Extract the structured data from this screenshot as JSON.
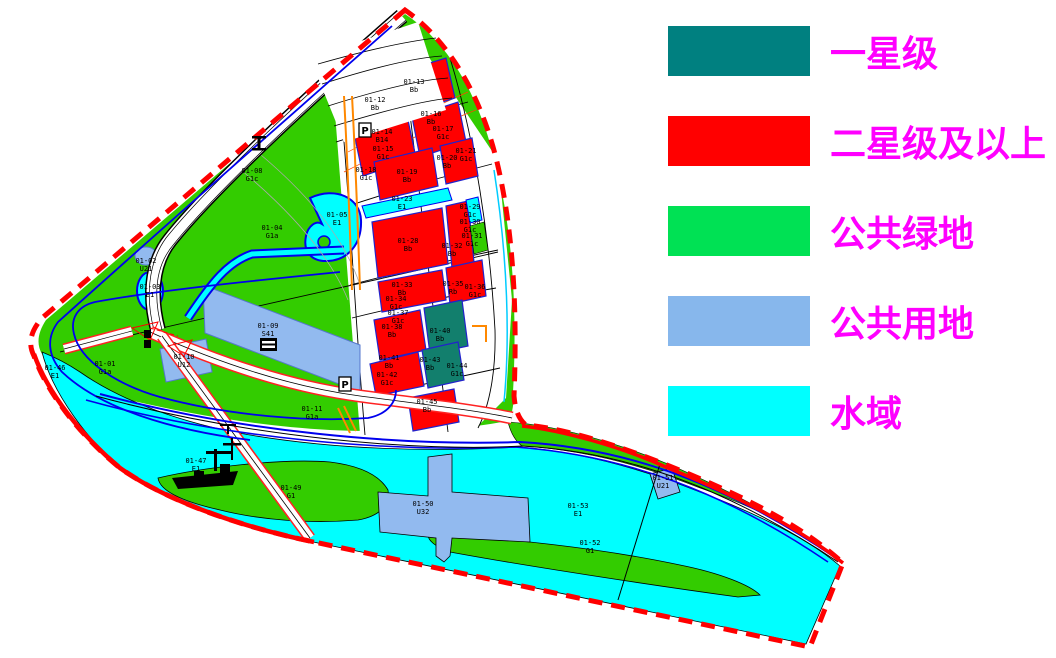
{
  "legend": {
    "text_color": "#FF00FF",
    "items": [
      {
        "label": "一星级",
        "color": "#008080"
      },
      {
        "label": "二星级及以上",
        "color": "#FF0000"
      },
      {
        "label": "公共绿地",
        "color": "#00E154"
      },
      {
        "label": "公共用地",
        "color": "#87B7EC"
      },
      {
        "label": "水域",
        "color": "#00FFFF"
      }
    ]
  },
  "map": {
    "colors": {
      "boundary_red": "#FF0000",
      "green_area": "#33CC00",
      "water_cyan": "#00FFFF",
      "public_blue": "#92BAEF",
      "block_red": "#FF0000",
      "block_teal": "#127F6D",
      "canal_blue": "#0000EE",
      "label_black": "#000000"
    },
    "parking_label": "P",
    "parcels": [
      {
        "c": "01-01",
        "t": "G1a",
        "x": 105,
        "y": 366
      },
      {
        "c": "01-02",
        "t": "U21",
        "x": 146,
        "y": 263
      },
      {
        "c": "01-03",
        "t": "E1",
        "x": 150,
        "y": 289
      },
      {
        "c": "01-04",
        "t": "G1a",
        "x": 272,
        "y": 230
      },
      {
        "c": "01-05",
        "t": "E1",
        "x": 337,
        "y": 217
      },
      {
        "c": "01-08",
        "t": "G1c",
        "x": 252,
        "y": 173
      },
      {
        "c": "01-09",
        "t": "S41",
        "x": 268,
        "y": 328
      },
      {
        "c": "01-10",
        "t": "U12",
        "x": 184,
        "y": 359
      },
      {
        "c": "01-11",
        "t": "G1a",
        "x": 312,
        "y": 411
      },
      {
        "c": "01-12",
        "t": "Bb",
        "x": 375,
        "y": 102
      },
      {
        "c": "01-13",
        "t": "Bb",
        "x": 414,
        "y": 84
      },
      {
        "c": "01-14",
        "t": "B14",
        "x": 382,
        "y": 134
      },
      {
        "c": "01-15",
        "t": "G1c",
        "x": 383,
        "y": 151
      },
      {
        "c": "01-16",
        "t": "Bb",
        "x": 431,
        "y": 116
      },
      {
        "c": "01-17",
        "t": "G1c",
        "x": 443,
        "y": 131
      },
      {
        "c": "01-18",
        "t": "G1c",
        "x": 366,
        "y": 172
      },
      {
        "c": "01-19",
        "t": "Bb",
        "x": 407,
        "y": 174
      },
      {
        "c": "01-20",
        "t": "Bb",
        "x": 447,
        "y": 160
      },
      {
        "c": "01-21",
        "t": "G1c",
        "x": 466,
        "y": 153
      },
      {
        "c": "01-23",
        "t": "E1",
        "x": 402,
        "y": 201
      },
      {
        "c": "01-28",
        "t": "Bb",
        "x": 408,
        "y": 243
      },
      {
        "c": "01-29",
        "t": "G1c",
        "x": 470,
        "y": 209
      },
      {
        "c": "01-30",
        "t": "G1c",
        "x": 470,
        "y": 224
      },
      {
        "c": "01-31",
        "t": "G1c",
        "x": 472,
        "y": 238
      },
      {
        "c": "01-32",
        "t": "Bb",
        "x": 452,
        "y": 248
      },
      {
        "c": "01-33",
        "t": "Bb",
        "x": 402,
        "y": 287
      },
      {
        "c": "01-34",
        "t": "G1c",
        "x": 396,
        "y": 301
      },
      {
        "c": "01-35",
        "t": "Rb",
        "x": 453,
        "y": 286
      },
      {
        "c": "01-36",
        "t": "G1c",
        "x": 475,
        "y": 289
      },
      {
        "c": "01-37",
        "t": "G1c",
        "x": 398,
        "y": 315
      },
      {
        "c": "01-38",
        "t": "Bb",
        "x": 392,
        "y": 329
      },
      {
        "c": "01-40",
        "t": "Bb",
        "x": 440,
        "y": 333
      },
      {
        "c": "01-41",
        "t": "Bb",
        "x": 389,
        "y": 360
      },
      {
        "c": "01-42",
        "t": "G1c",
        "x": 387,
        "y": 377
      },
      {
        "c": "01-43",
        "t": "Bb",
        "x": 430,
        "y": 362
      },
      {
        "c": "01-44",
        "t": "G1c",
        "x": 457,
        "y": 368
      },
      {
        "c": "01-45",
        "t": "Bb",
        "x": 427,
        "y": 404
      },
      {
        "c": "01-46",
        "t": "E1",
        "x": 55,
        "y": 370
      },
      {
        "c": "01-47",
        "t": "E1",
        "x": 196,
        "y": 463
      },
      {
        "c": "01-49",
        "t": "G1",
        "x": 291,
        "y": 490
      },
      {
        "c": "01-50",
        "t": "U32",
        "x": 423,
        "y": 506
      },
      {
        "c": "01-51",
        "t": "U21",
        "x": 663,
        "y": 480
      },
      {
        "c": "01-52",
        "t": "G1",
        "x": 590,
        "y": 545
      },
      {
        "c": "01-53",
        "t": "E1",
        "x": 578,
        "y": 508
      }
    ]
  }
}
